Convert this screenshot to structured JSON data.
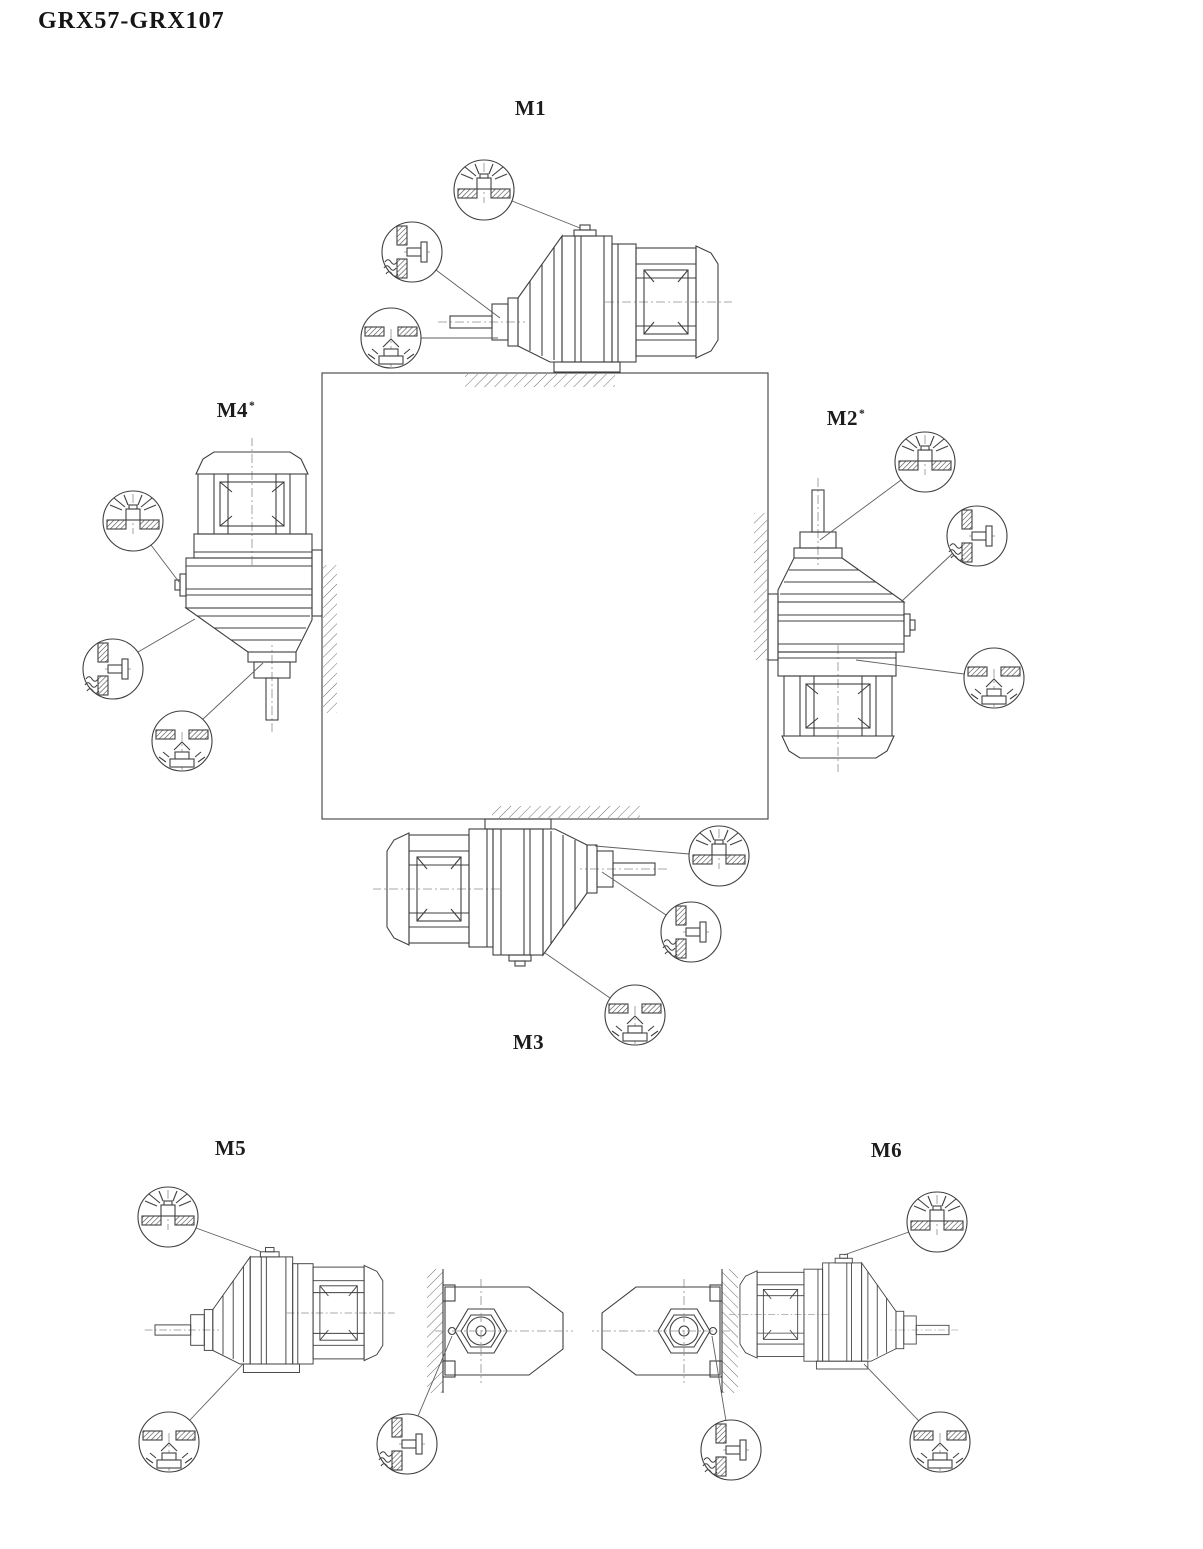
{
  "page": {
    "title": "GRX57-GRX107"
  },
  "positions": [
    {
      "id": "M1",
      "label": "M1",
      "asterisk": "",
      "plug_symbols": [
        "breather-plug-icon",
        "oil-level-plug-icon",
        "oil-drain-plug-icon"
      ]
    },
    {
      "id": "M2",
      "label": "M2",
      "asterisk": "*",
      "plug_symbols": [
        "breather-plug-icon",
        "oil-level-plug-icon",
        "oil-drain-plug-icon"
      ]
    },
    {
      "id": "M3",
      "label": "M3",
      "asterisk": "",
      "plug_symbols": [
        "breather-plug-icon",
        "oil-level-plug-icon",
        "oil-drain-plug-icon"
      ]
    },
    {
      "id": "M4",
      "label": "M4",
      "asterisk": "*",
      "plug_symbols": [
        "breather-plug-icon",
        "oil-level-plug-icon",
        "oil-drain-plug-icon"
      ]
    },
    {
      "id": "M5",
      "label": "M5",
      "asterisk": "",
      "plug_symbols": [
        "breather-plug-icon",
        "oil-level-plug-icon",
        "oil-drain-plug-icon"
      ]
    },
    {
      "id": "M6",
      "label": "M6",
      "asterisk": "",
      "plug_symbols": [
        "breather-plug-icon",
        "oil-level-plug-icon",
        "oil-drain-plug-icon"
      ]
    }
  ],
  "diagram": {
    "symbols": {
      "breather": "breather-plug-icon",
      "oil_level": "oil-level-plug-icon",
      "oil_drain": "oil-drain-plug-icon"
    },
    "colors": {
      "line": "#3f3f3f",
      "hatch": "#6e6e6e",
      "text": "#1c1c1c",
      "background": "#ffffff"
    }
  }
}
